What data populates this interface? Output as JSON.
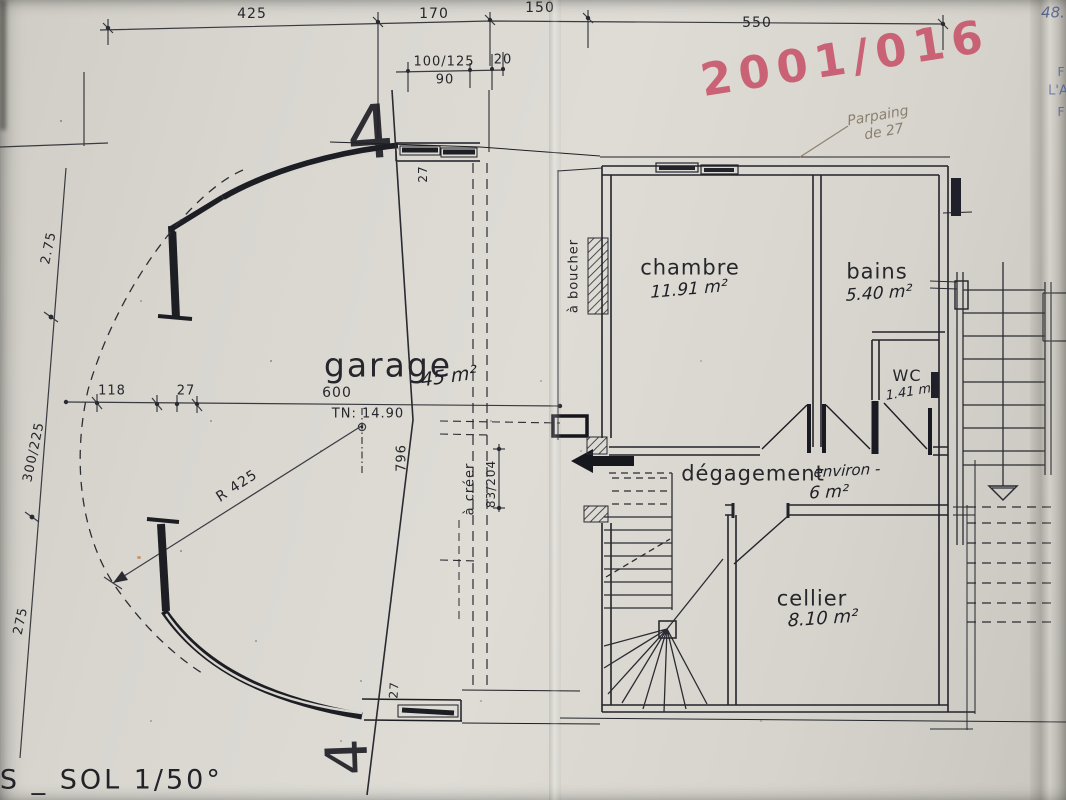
{
  "sheet": {
    "title": "US _ SOL   1/50°",
    "stamp_number": "2001/016",
    "blue_note": "48.",
    "blue_fragment_1": "F",
    "blue_fragment_2": "L'A",
    "blue_fragment_3": "F",
    "pencil_note_line1": "Parpaing",
    "pencil_note_line2": "de 27",
    "section_marker": "4"
  },
  "rooms": {
    "garage": {
      "label": "garage",
      "area": "45 m²"
    },
    "chambre": {
      "label": "chambre",
      "area": "11.91 m²"
    },
    "bains": {
      "label": "bains",
      "area": "5.40 m²"
    },
    "wc": {
      "label": "WC",
      "area": "1.41 m²"
    },
    "degagement": {
      "label": "dégagement",
      "qualifier": "environ -",
      "area": "6 m²"
    },
    "cellier": {
      "label": "cellier",
      "area": "8.10 m²"
    }
  },
  "annotations": {
    "a_boucher": "à boucher",
    "a_creer": "à créer",
    "tn_level": "TN: 14.90",
    "radius": "R 425"
  },
  "dimensions": {
    "top_1": "425",
    "top_2": "170",
    "top_3": "150",
    "top_4": "550",
    "sub_1": "100/125",
    "sub_2": "90",
    "sub_3": "20",
    "left_1": "2.75",
    "left_2": "300/225",
    "left_3": "275",
    "garage_width_1": "118",
    "garage_width_2": "27",
    "garage_width_3": "600",
    "garage_depth": "796",
    "wall_top": "27",
    "wall_bottom": "27",
    "opening": "83/204"
  }
}
